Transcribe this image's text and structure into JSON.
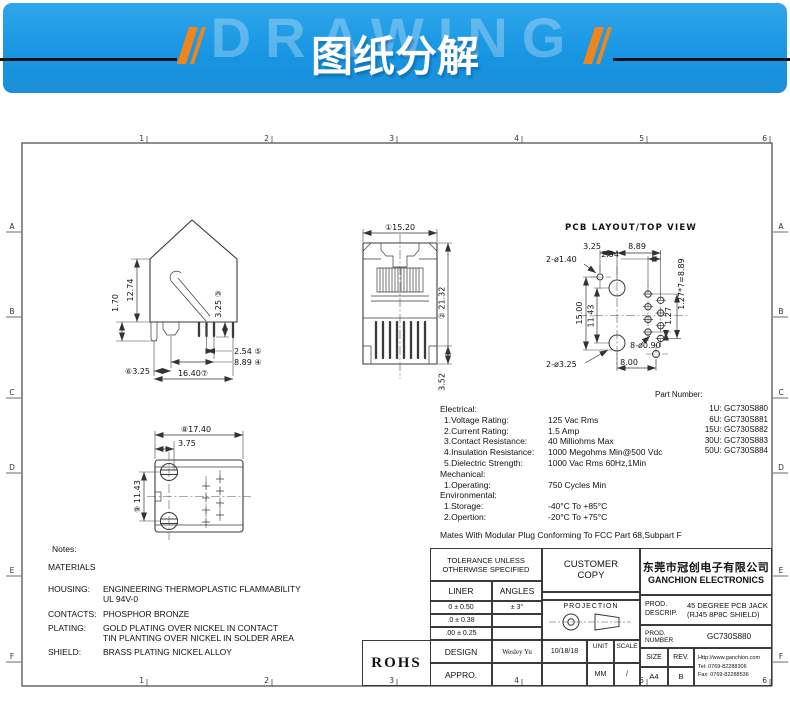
{
  "banner": {
    "watermark": "DRAWING",
    "title": "图纸分解",
    "bg_color": "#1795e2",
    "accent_color": "#f0861b"
  },
  "zones": {
    "cols": [
      "1",
      "2",
      "3",
      "4",
      "5",
      "6"
    ],
    "rows": [
      "A",
      "B",
      "C",
      "D",
      "E",
      "F"
    ]
  },
  "views": {
    "side": {
      "d_1_70": "1.70",
      "d_12_74": "12.74",
      "d_3_25_v": "3.25 ③",
      "d_2_54": "2.54 ⑤",
      "d_8_89": "8.89 ④",
      "d_3_25_h": "⑥3.25",
      "d_16_40": "16.40⑦"
    },
    "front": {
      "d_width": "①15.20",
      "d_height": "② 21.32",
      "d_3_52": "3.52"
    },
    "pcb": {
      "title": "PCB LAYOUT/TOP VIEW",
      "d_3_25": "3.25",
      "d_8_89": "8.89",
      "d_2_54": "2.54",
      "d_pitch": "1.27*7=8.89",
      "d_hole_small": "2-ø1.40",
      "d_15_00": "15.00",
      "d_11_43": "11.43",
      "d_1_27": "1.27",
      "d_pins": "8-ø0.90",
      "d_8_00": "8.00",
      "d_hole_big": "2-ø3.25"
    },
    "top": {
      "d_17_40": "⑧17.40",
      "d_3_75": "3.75",
      "d_11_43": "⑨ 11.43"
    }
  },
  "part_numbers": {
    "title": "Part Number:",
    "items": [
      "1U: GC730S880",
      "6U: GC730S881",
      "15U: GC730S882",
      "30U: GC730S883",
      "50U: GC730S884"
    ]
  },
  "specs": {
    "electrical_title": "Electrical:",
    "e1l": "1.Voltage Rating:",
    "e1v": "125 Vac Rms",
    "e2l": "2.Current Rating:",
    "e2v": "1.5 Amp",
    "e3l": "3.Contact Resistance:",
    "e3v": "40 Milliohms Max",
    "e4l": "4.Insulation Resistance:",
    "e4v": "1000 Megohms Min@500 Vdc",
    "e5l": "5.Dielectric Strength:",
    "e5v": "1000 Vac Rms 60Hz,1Min",
    "mechanical_title": "Mechanical:",
    "m1l": "1.Operating:",
    "m1v": "750 Cycles Min",
    "environmental_title": "Environmental:",
    "n1l": "1.Storage:",
    "n1v": "-40°C To +85°C",
    "n2l": "2.Opertion:",
    "n2v": "-20°C To +75°C",
    "footnote": "Mates With Modular Plug Conforming To FCC Part 68,Subpart F"
  },
  "notes": {
    "title": "Notes:",
    "materials": "MATERIALS",
    "housing_label": "HOUSING:",
    "housing_1": "ENGINEERING THERMOPLASTIC FLAMMABILITY",
    "housing_2": "UL 94V-0",
    "contacts_label": "CONTACTS:",
    "contacts": "PHOSPHOR BRONZE",
    "plating_label": "PLATING:",
    "plating_1": "GOLD PLATING OVER NICKEL IN CONTACT",
    "plating_2": "TIN PLANTING OVER NICKEL IN SOLDER AREA",
    "shield_label": "SHIELD:",
    "shield": "BRASS PLATING NICKEL ALLOY"
  },
  "title_block": {
    "tolerance_header": "TOLERANCE UNLESS OTHERWISE SPECIFIED",
    "liner": "LINER",
    "angles": "ANGLES",
    "tol1": "0 ± 0.50",
    "ang1": "± 3°",
    "tol2": ".0 ± 0.38",
    "tol3": ".00 ± 0.25",
    "customer_copy": "CUSTOMER COPY",
    "projection": "PROJECTION",
    "company_cn": "东莞市冠创电子有限公司",
    "company_en": "GANCHION ELECTRONICS",
    "prod1": "PROD.",
    "descrip": "DESCRIP.",
    "descrip_v1": "45 DEGREE PCB JACK",
    "descrip_v2": "(RJ45 8P8C SHIELD)",
    "prod2": "PROD.",
    "number": "NUMBER",
    "number_v": "GC730S880",
    "design": "DESIGN",
    "designer": "Wesley Yu",
    "date": "10/18/18",
    "appro": "APPRO.",
    "unit": "UNIT",
    "unit_v": "MM",
    "scale": "SCALE",
    "scale_v": "/",
    "size": "SIZE",
    "size_v": "A4",
    "rev": "REV.",
    "rev_v": "B",
    "website": "Http://www.ganchion.com",
    "tel": "Tel: 0769-82288306",
    "fax": "Fax: 0769-82288536",
    "rohs": "ROHS"
  }
}
